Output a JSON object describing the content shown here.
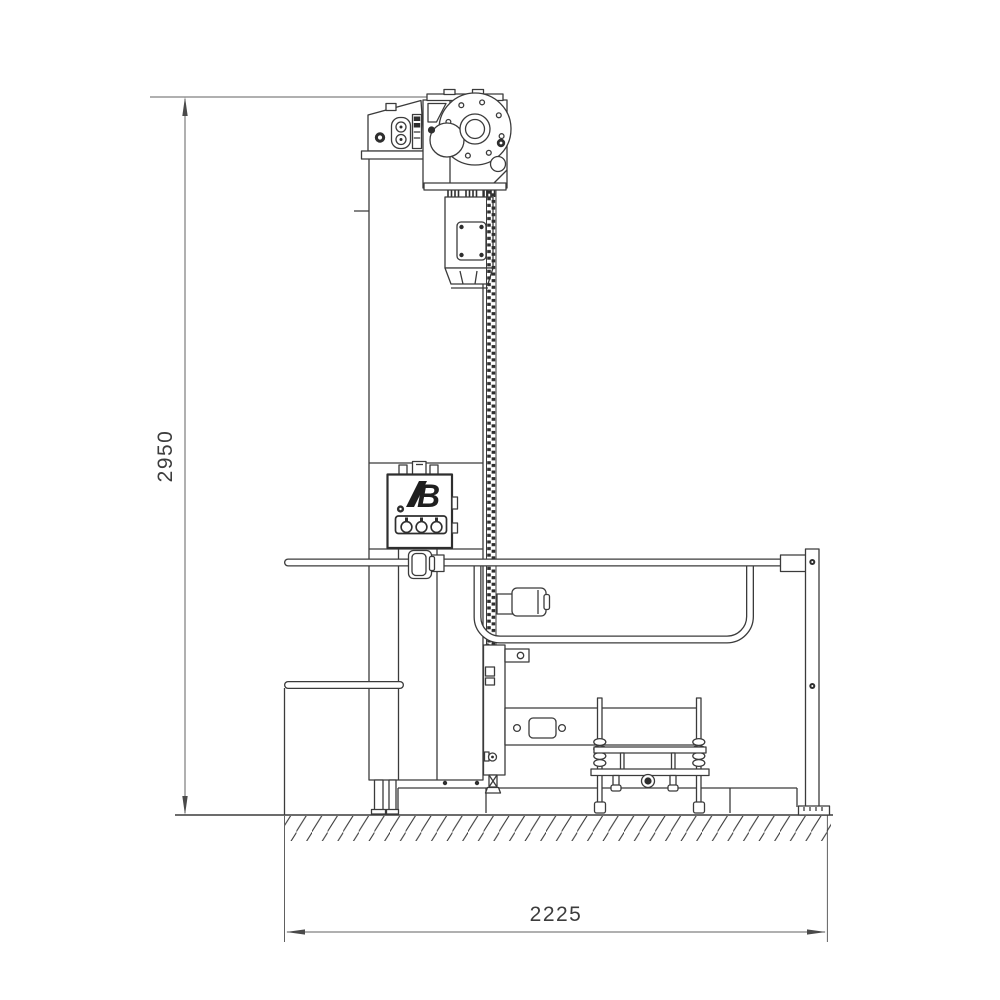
{
  "page": {
    "background": "#ffffff"
  },
  "drawing": {
    "type": "technical-drawing",
    "view": "side-elevation",
    "line_color": "#3b3b3b",
    "dimension_color": "#606060",
    "dark_fill": "#2e2e2e"
  },
  "dimensions": {
    "height": {
      "value": "2950"
    },
    "width": {
      "value": "2225"
    }
  },
  "logo": {
    "text": "B"
  }
}
